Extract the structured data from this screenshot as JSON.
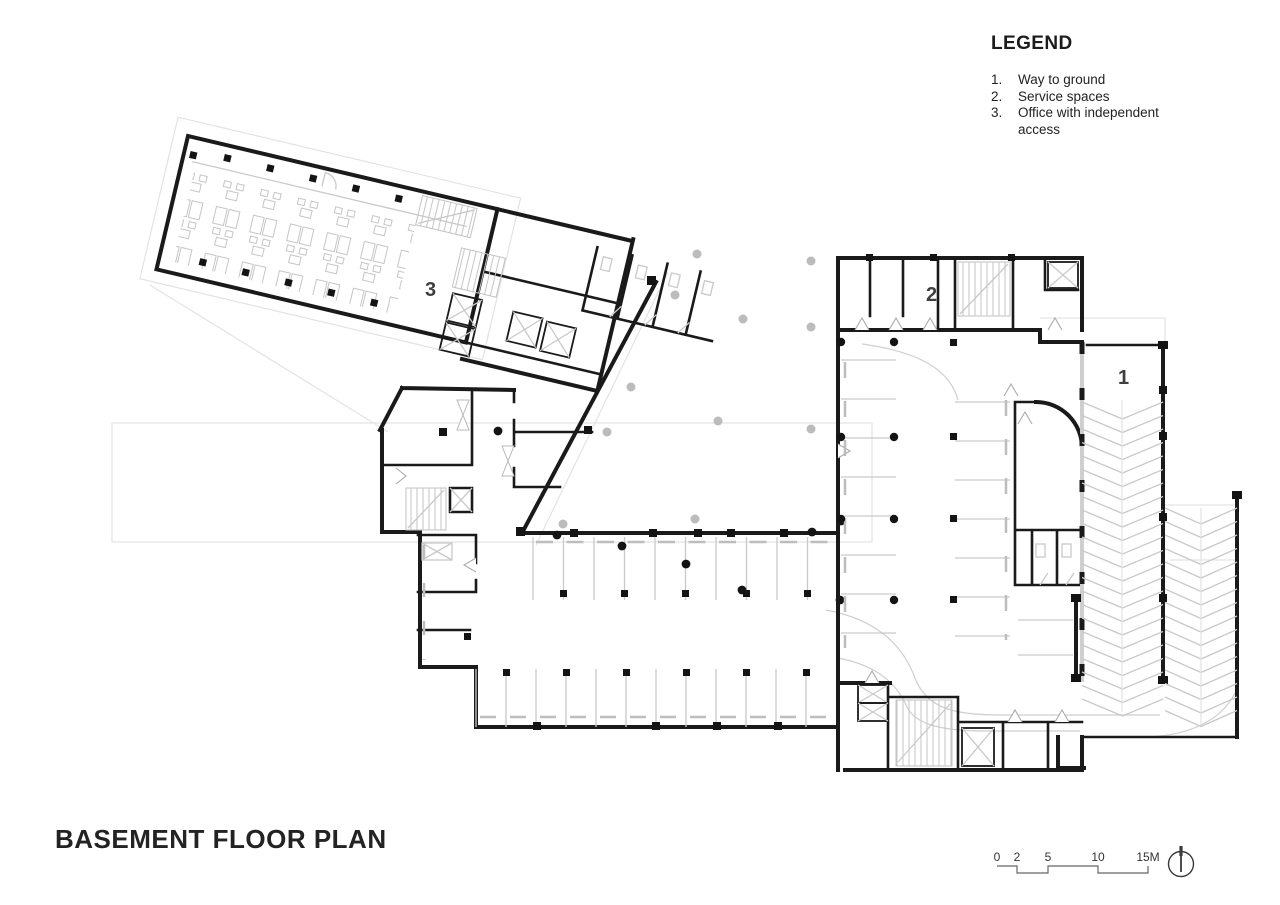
{
  "legend": {
    "title": "LEGEND",
    "items": [
      {
        "num": "1.",
        "label": "Way to ground"
      },
      {
        "num": "2.",
        "label": "Service spaces"
      },
      {
        "num": "3.",
        "label": "Office with independent access"
      }
    ]
  },
  "plan": {
    "title": "BASEMENT FLOOR PLAN",
    "zones": [
      {
        "text": "1"
      },
      {
        "text": "2"
      },
      {
        "text": "3"
      }
    ]
  },
  "scale_bar": {
    "ticks": [
      "0",
      "2",
      "5",
      "10",
      "15M"
    ]
  },
  "icons": {
    "north": "north-arrow-icon"
  },
  "colors": {
    "background": "#ffffff",
    "wall": "#1a1a1a",
    "light_detail": "#c9c9c9",
    "ghost_outline": "#e3e3e3",
    "lane_line": "#cfcfcf",
    "zone_label": "#3f3f3f",
    "column_dot_gray": "#bcbcbc"
  }
}
